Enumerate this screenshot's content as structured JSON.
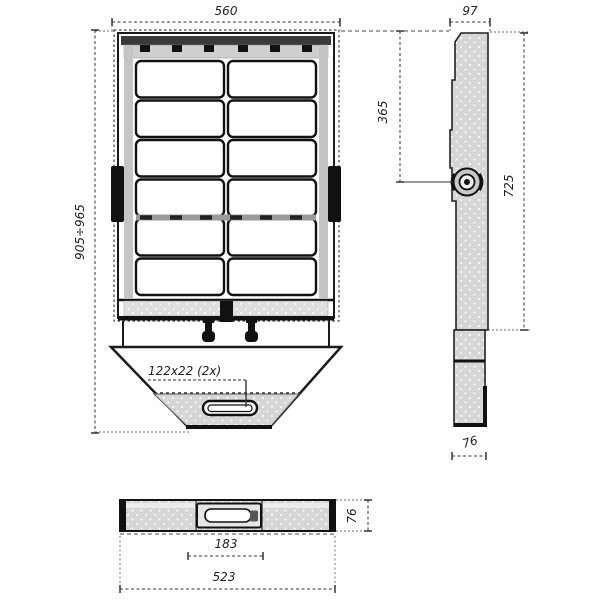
{
  "drawing": {
    "dims": {
      "overall_width": "560",
      "side_depth": "97",
      "pivot_from_top": "365",
      "body_height": "725",
      "overall_height": "905÷965",
      "slot_label": "122x22 (2x)",
      "arm_width": "76",
      "profile_height": "76",
      "connector_width": "183",
      "body_width": "523"
    },
    "colors": {
      "line": "#1a1a1a",
      "fill_light": "#d6d6d6",
      "fill_dark": "#111111",
      "background": "#ffffff"
    }
  }
}
